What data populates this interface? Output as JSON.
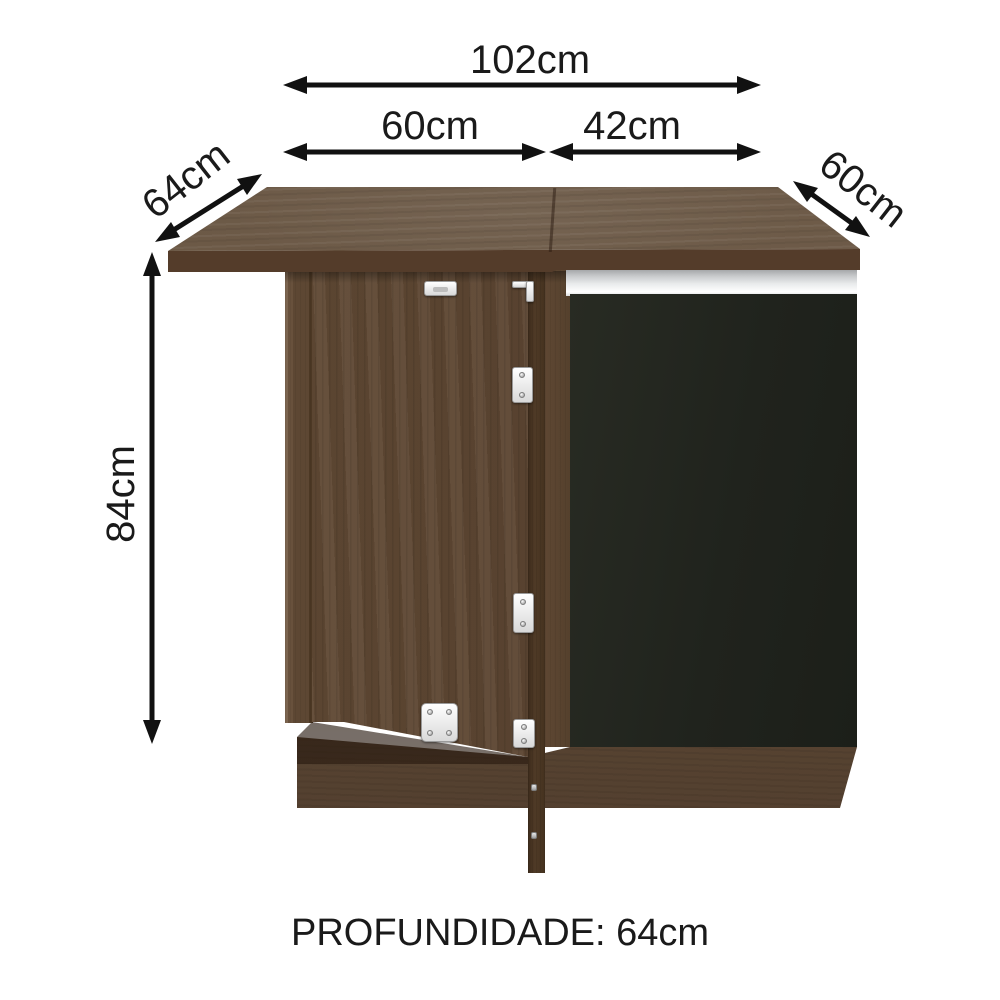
{
  "labels": {
    "total_width": "102cm",
    "left_section_width": "60cm",
    "right_section_width": "42cm",
    "left_depth": "64cm",
    "right_depth": "60cm",
    "height": "84cm",
    "depth_caption": "PROFUNDIDADE: 64cm"
  },
  "colors": {
    "background": "#ffffff",
    "arrow": "#111111",
    "countertop_wood": "#695643",
    "front_wood": "#5c4531",
    "black_door": "#23261f",
    "silver_handle": "#d5d7d8",
    "toe_kick_wood": "#5a4634",
    "hardware_white": "#f2f2f2"
  }
}
